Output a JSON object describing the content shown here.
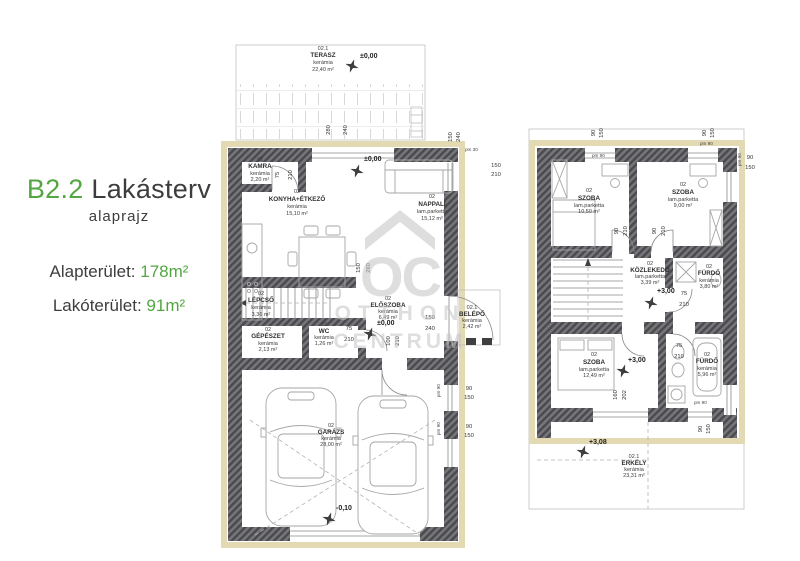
{
  "panel": {
    "title_code": "B2.2",
    "title_name": "Lakásterv",
    "subtitle": "alaprajz",
    "stat1_label": "Alapterület:",
    "stat1_value": "178m²",
    "stat2_label": "Lakóterület:",
    "stat2_value": "91m²",
    "accent_color": "#53a640"
  },
  "watermark": {
    "monogram": "OC",
    "line1": "OTTHON",
    "line2": "CENTRUM"
  },
  "gf": {
    "rooms": {
      "terasz": {
        "num": "02.1",
        "name": "TERASZ",
        "mat": "kerámia",
        "area": "22,40 m²"
      },
      "kamra": {
        "num": "02",
        "name": "KAMRA",
        "mat": "kerámia",
        "area": "2,20 m²"
      },
      "konyha": {
        "num": "02",
        "name": "KONYHA+ÉTKEZŐ",
        "mat": "kerámia",
        "area": "15,10 m²"
      },
      "nappali": {
        "num": "02",
        "name": "NAPPALI",
        "mat": "lam.parketta",
        "area": "15,12 m²"
      },
      "lepcso": {
        "num": "02",
        "name": "LÉPCSŐ",
        "mat": "kerámia",
        "area": "3,36 m²"
      },
      "eloszoba": {
        "num": "02",
        "name": "ELŐSZOBA",
        "mat": "kerámia",
        "area": "6,49 m²"
      },
      "gepeszet": {
        "num": "02",
        "name": "GÉPÉSZET",
        "mat": "kerámia",
        "area": "2,13 m²"
      },
      "wc": {
        "num": "02",
        "name": "WC",
        "mat": "kerámia",
        "area": "1,26 m²"
      },
      "belepo": {
        "num": "02.1",
        "name": "BELÉPŐ",
        "mat": "kerámia",
        "area": "2,42 m²"
      },
      "garazs": {
        "num": "02",
        "name": "GARÁZS",
        "mat": "kerámia",
        "area": "28,00 m²"
      }
    },
    "levels": {
      "terasz": "±0,00",
      "foter": "±0,00",
      "eloszoba": "±0,00",
      "garazs": "-0,10"
    },
    "dims": {
      "terasz_w": "280",
      "terasz_h": "240",
      "kamra_w": "75",
      "kamra_h": "210",
      "konyha_w": "150",
      "konyha_h": "260",
      "tr_w": "150",
      "tr_h": "240",
      "win_r_p": "pm 30",
      "win_r_w": "150",
      "win_r_h": "210",
      "wc_w": "75",
      "wc_h": "210",
      "gar_door_w": "100",
      "gar_door_h": "210",
      "belepo_w": "150",
      "belepo_h": "240",
      "gw1_p": "pm 90",
      "gw1_w": "90",
      "gw1_h": "150",
      "gw2_p": "pm 90",
      "gw2_w": "90",
      "gw2_h": "150"
    }
  },
  "uf": {
    "rooms": {
      "szoba1": {
        "num": "02",
        "name": "SZOBA",
        "mat": "lam.parketta",
        "area": "10,50 m²"
      },
      "szoba2": {
        "num": "02",
        "name": "SZOBA",
        "mat": "lam.parketta",
        "area": "9,00 m²"
      },
      "kozlekedo": {
        "num": "02",
        "name": "KÖZLEKEDŐ",
        "mat": "lam.parketta",
        "area": "3,39 m²"
      },
      "furdo1": {
        "num": "02",
        "name": "FÜRDŐ",
        "mat": "kerámia",
        "area": "3,80 m²"
      },
      "szoba3": {
        "num": "02",
        "name": "SZOBA",
        "mat": "lam.parketta",
        "area": "12,49 m²"
      },
      "furdo2": {
        "num": "02",
        "name": "FÜRDŐ",
        "mat": "kerámia",
        "area": "5,96 m²"
      },
      "erkely": {
        "num": "02.1",
        "name": "ERKÉLY",
        "mat": "kerámia",
        "area": "23,31 m²"
      }
    },
    "levels": {
      "kozlekedo": "+3,00",
      "szoba3": "+3,00",
      "erkely": "+3,08"
    },
    "dims": {
      "w1_w": "90",
      "w1_h": "150",
      "w1_p": "pm 90",
      "w2_w": "90",
      "w2_h": "150",
      "w2_p": "pm 90",
      "wr_w": "90",
      "wr_h": "150",
      "wr_p": "pm 90",
      "d1_w": "90",
      "d1_h": "210",
      "d2_w": "90",
      "d2_h": "210",
      "f1_w": "75",
      "f1_h": "210",
      "f2_w": "75",
      "f2_h": "210",
      "bal_w": "160",
      "bal_h": "202",
      "fw_p": "pm 90",
      "fw_w": "90",
      "fw_h": "150"
    }
  }
}
